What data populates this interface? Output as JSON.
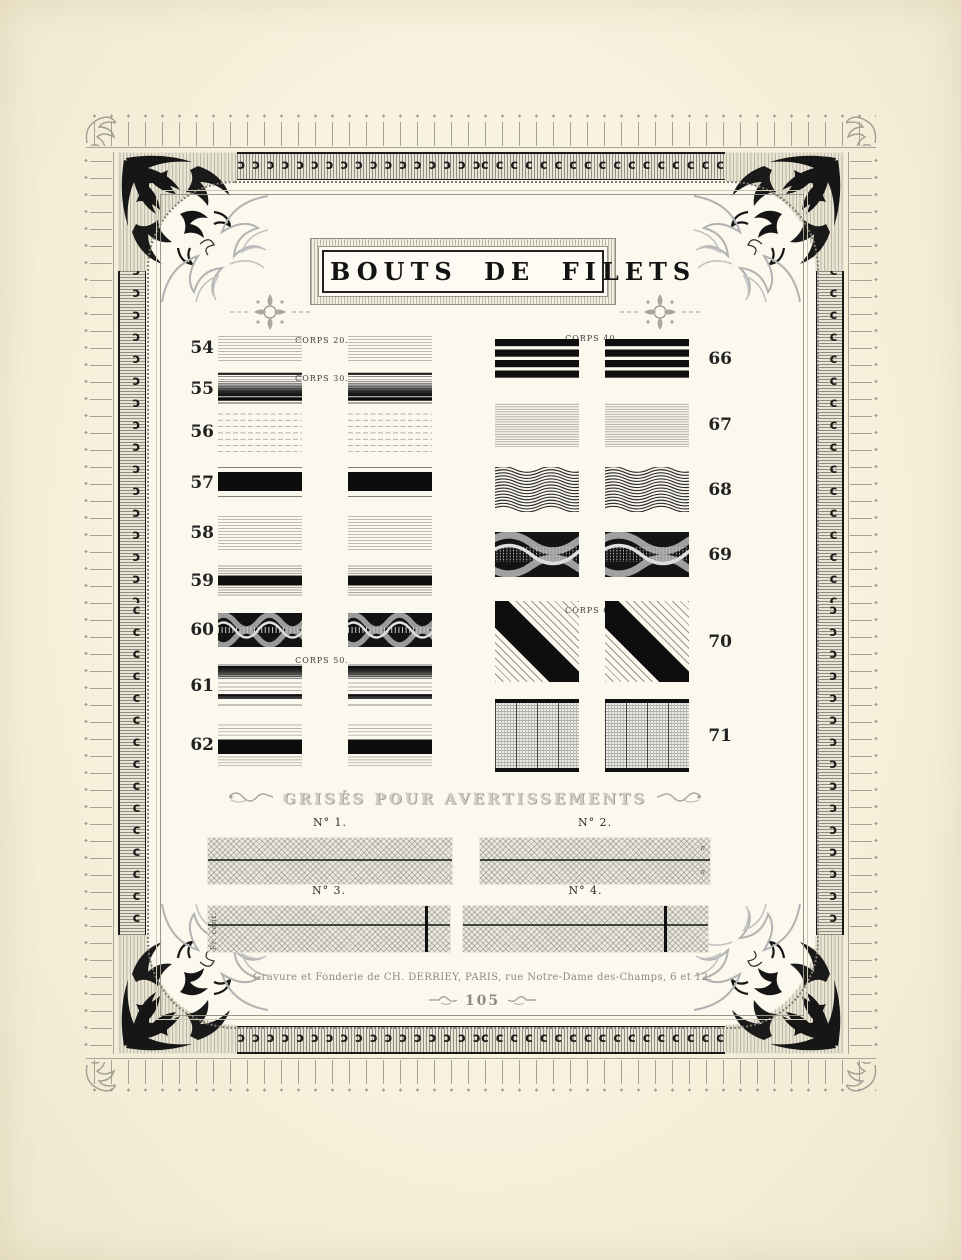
{
  "title": "BOUTS DE FILETS",
  "specimens": {
    "left": [
      {
        "number": "54",
        "corps_label": "CORPS 20.",
        "pattern": "fine-light"
      },
      {
        "number": "55",
        "corps_label": "CORPS 30.",
        "pattern": "graduated-down"
      },
      {
        "number": "56",
        "corps_label": "",
        "pattern": "sparse-rules"
      },
      {
        "number": "57",
        "corps_label": "",
        "pattern": "solid-bar"
      },
      {
        "number": "58",
        "corps_label": "",
        "pattern": "fine-light"
      },
      {
        "number": "59",
        "corps_label": "",
        "pattern": "bar-between-rules"
      },
      {
        "number": "60",
        "corps_label": "",
        "pattern": "wave-interlace"
      },
      {
        "number": "61",
        "corps_label": "CORPS 50.",
        "pattern": "graduated-up"
      },
      {
        "number": "62",
        "corps_label": "",
        "pattern": "bar-between-sparse-rules"
      }
    ],
    "right": [
      {
        "number": "66",
        "corps_label": "CORPS 40.",
        "pattern": "four-bars"
      },
      {
        "number": "67",
        "corps_label": "",
        "pattern": "fine-dense"
      },
      {
        "number": "68",
        "corps_label": "",
        "pattern": "wavy-rules"
      },
      {
        "number": "69",
        "corps_label": "",
        "pattern": "ornamental-wave-band"
      },
      {
        "number": "70",
        "corps_label": "CORPS 60.",
        "pattern": "diagonal-stripe"
      },
      {
        "number": "71",
        "corps_label": "",
        "pattern": "woven-columns"
      }
    ]
  },
  "grises": {
    "heading": "GRISÉS POUR AVERTISSEMENTS",
    "items": [
      {
        "label": "N° 1.",
        "side_text": "",
        "vertical_rule": false
      },
      {
        "label": "N° 2.",
        "side_text": "n n",
        "vertical_rule": false
      },
      {
        "label": "N° 3.",
        "side_text": "Fr. cent.",
        "vertical_rule": true
      },
      {
        "label": "N° 4.",
        "side_text": "",
        "vertical_rule": true
      }
    ]
  },
  "footer": {
    "imprint": "Gravure et Fonderie de CH. DERRIEY, PARIS, rue Notre-Dame des-Champs, 6 et 12.",
    "page_number": "105"
  },
  "colors": {
    "paper": "#f7f1dd",
    "ink": "#161616",
    "ornament_gray": "#a4a298"
  }
}
